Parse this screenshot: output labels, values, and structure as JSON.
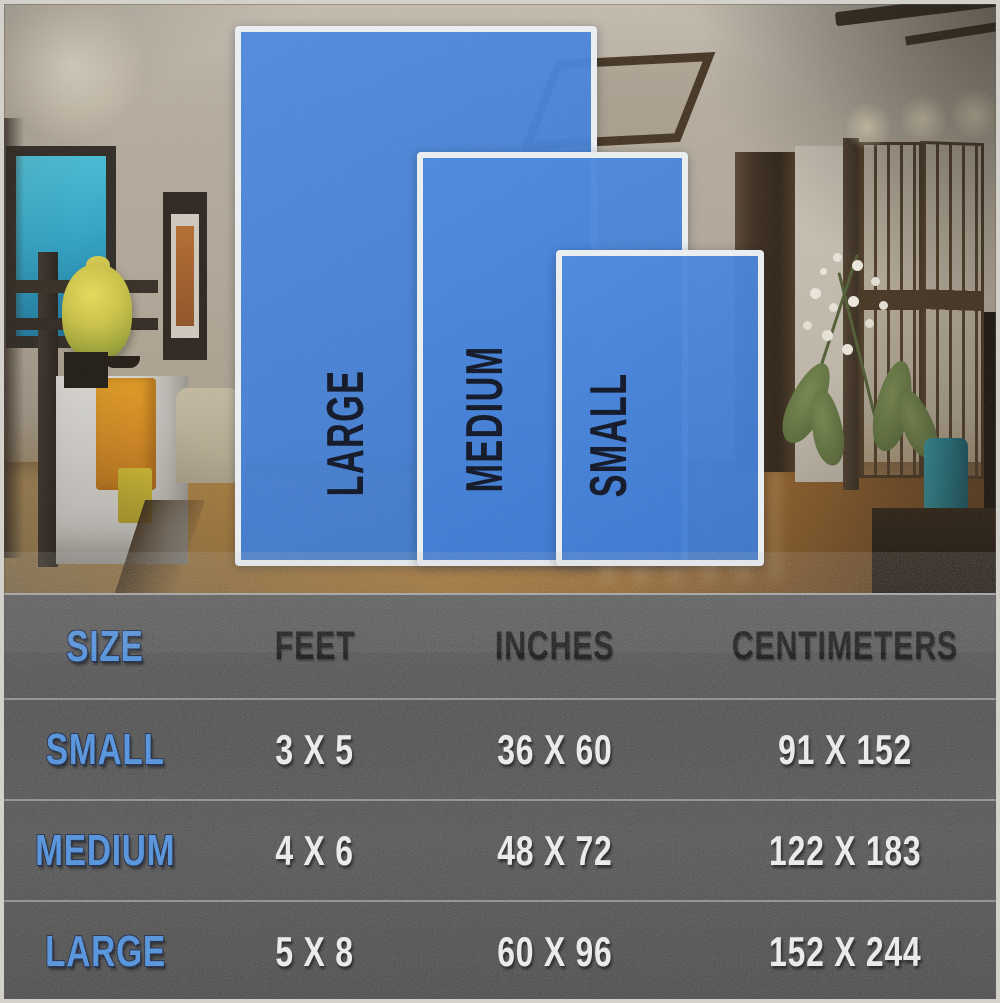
{
  "diagram": {
    "rugs": [
      {
        "id": "large",
        "label": "LARGE"
      },
      {
        "id": "medium",
        "label": "MEDIUM"
      },
      {
        "id": "small",
        "label": "SMALL"
      }
    ],
    "rug_color": "#3b7ede",
    "rug_border_color": "#eef2f5"
  },
  "table": {
    "columns": [
      "SIZE",
      "FEET",
      "INCHES",
      "CENTIMETERS"
    ],
    "rows": [
      {
        "size": "SMALL",
        "feet": "3 X 5",
        "inches": "36 X 60",
        "centimeters": "91 X 152"
      },
      {
        "size": "MEDIUM",
        "feet": "4 X 6",
        "inches": "48 X 72",
        "centimeters": "122 X 183"
      },
      {
        "size": "LARGE",
        "feet": "5 X 8",
        "inches": "60 X 96",
        "centimeters": "152 X 244"
      }
    ]
  },
  "colors": {
    "accent_blue_text": "#4a90e2",
    "table_background": "#4f4f4f",
    "value_text": "#f3f3f1",
    "header_text": "#0d0d0d"
  },
  "chart_data": {
    "type": "table",
    "columns": [
      "SIZE",
      "FEET",
      "INCHES",
      "CENTIMETERS"
    ],
    "rows": [
      [
        "SMALL",
        "3 X 5",
        "36 X 60",
        "91 X 152"
      ],
      [
        "MEDIUM",
        "4 X 6",
        "48 X 72",
        "122 X 183"
      ],
      [
        "LARGE",
        "5 X 8",
        "60 X 96",
        "152 X 244"
      ]
    ],
    "sizes_feet": {
      "SMALL": [
        3,
        5
      ],
      "MEDIUM": [
        4,
        6
      ],
      "LARGE": [
        5,
        8
      ]
    },
    "sizes_inches": {
      "SMALL": [
        36,
        60
      ],
      "MEDIUM": [
        48,
        72
      ],
      "LARGE": [
        60,
        96
      ]
    },
    "sizes_centimeters": {
      "SMALL": [
        91,
        152
      ],
      "MEDIUM": [
        122,
        183
      ],
      "LARGE": [
        152,
        244
      ]
    }
  }
}
